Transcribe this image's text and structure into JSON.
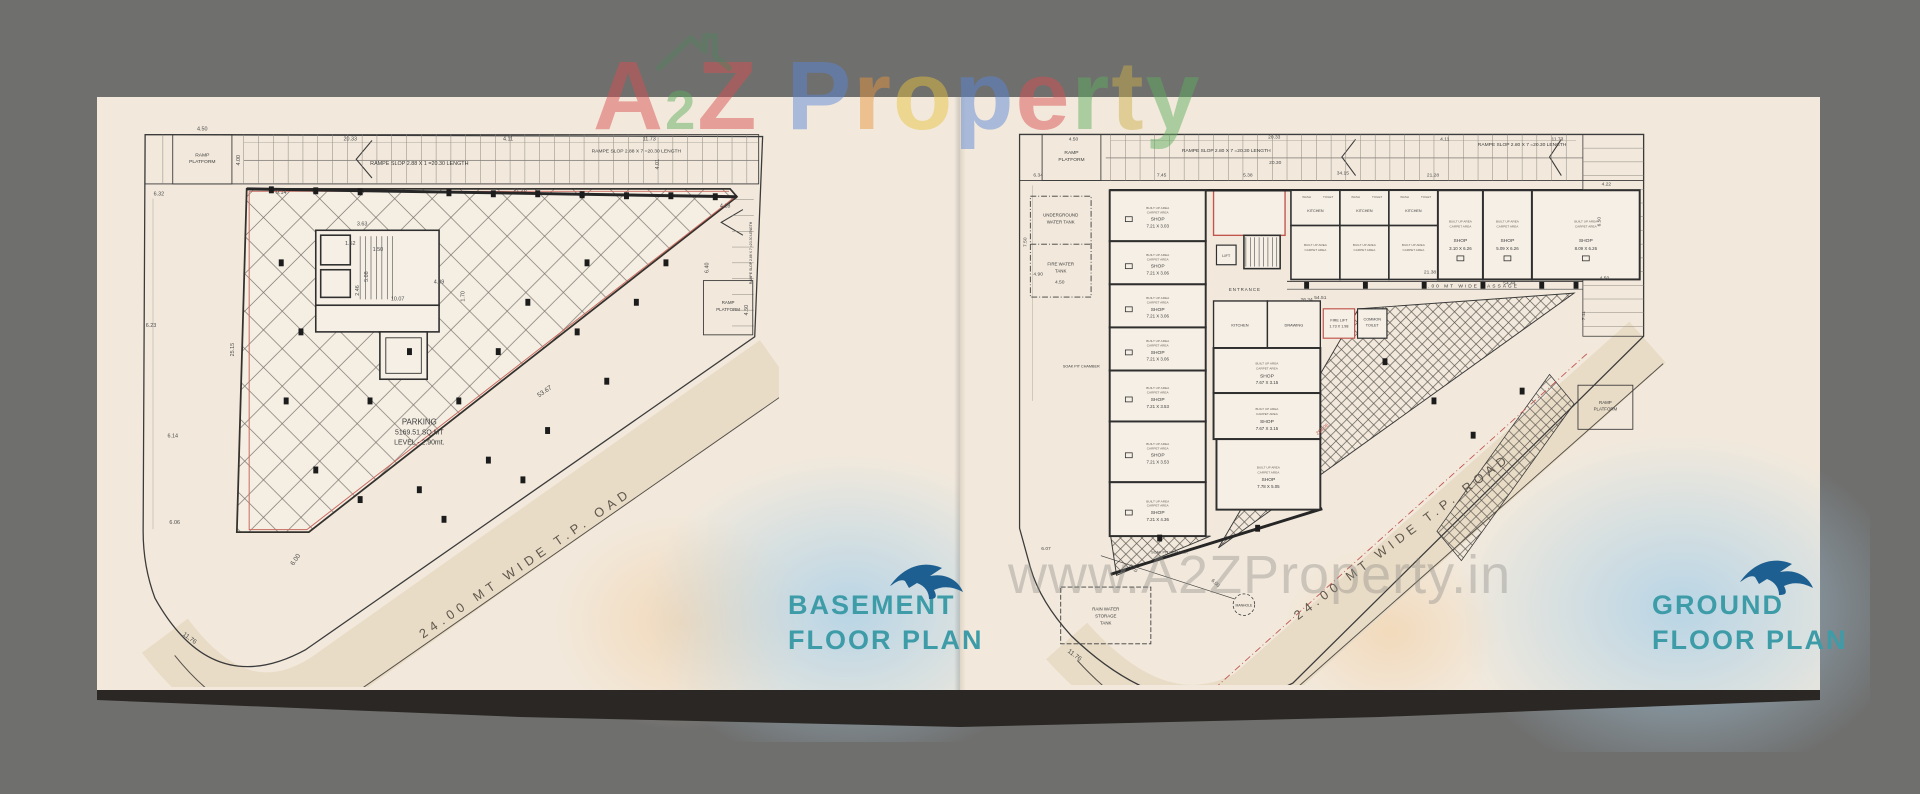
{
  "colors": {
    "background": "#6f6f6e",
    "panel": "#f2e9dc",
    "road": "#e9dcc6",
    "line": "#3b3b3b",
    "red_accent": "#c0564e",
    "title_teal": "#3D9CA8",
    "bird_blue": "#1D5F90",
    "shadow": "#2a2724",
    "watermark_gray": "#8b8a86"
  },
  "watermark_top": {
    "word1_letters": [
      {
        "ch": "A",
        "c": "#db4f4f",
        "sub": false
      },
      {
        "ch": "2",
        "c": "#5fae5f",
        "sub": true
      },
      {
        "ch": "Z",
        "c": "#db4f4f",
        "sub": false
      }
    ],
    "word2_letters": [
      {
        "ch": "P",
        "c": "#5b87d7",
        "sub": false
      },
      {
        "ch": "r",
        "c": "#e8953f",
        "sub": false
      },
      {
        "ch": "o",
        "c": "#e6c23e",
        "sub": false
      },
      {
        "ch": "p",
        "c": "#5b87d7",
        "sub": false
      },
      {
        "ch": "e",
        "c": "#db4f4f",
        "sub": false
      },
      {
        "ch": "r",
        "c": "#5fae5f",
        "sub": false
      },
      {
        "ch": "t",
        "c": "#cdb04a",
        "sub": false
      },
      {
        "ch": "y",
        "c": "#5fae5f",
        "sub": false
      }
    ]
  },
  "watermark_center": "www.A2ZProperty.in",
  "basement": {
    "title": [
      "BASEMENT",
      "FLOOR PLAN"
    ],
    "ramp_platform": [
      "RAMP",
      "PLATFORM"
    ],
    "ramp_platform_right": [
      "RAMP",
      "PLATFORM"
    ],
    "ramp_label_left": "RAMPE SLOP 2.88 X 1 =20.30 LENGTH",
    "ramp_label_right": "RAMPE SLOP 2.88 X 7 =20.30 LENGTH",
    "ramp_label_side": "RAMPE SLOP 2.88 X 7 =20.30 LENGTH",
    "parking": [
      "PARKING",
      "5169.51 SQ.MT",
      "LEVEL - 2.90mt."
    ],
    "road": "24.00 MT WIDE T.P.  OAD",
    "dims": [
      "4.50",
      "20.33",
      "4.11",
      "11.73",
      "6.32",
      "9.14",
      "21.28",
      "6.23",
      "25.15",
      "6.14",
      "6.06",
      "4.00",
      "4.18",
      "6.40",
      "4.50",
      "4.01",
      "3.63",
      "1.52",
      "1.50",
      "5.08",
      "2.46",
      "10.07",
      "4.39",
      "1.70",
      "53.67",
      "6.00",
      "11.76"
    ]
  },
  "ground": {
    "title": [
      "GROUND",
      "FLOOR PLAN"
    ],
    "ramp_platform": [
      "RAMP",
      "PLATFORM"
    ],
    "ramp_platform_right": [
      "RAMP",
      "PLATFORM"
    ],
    "ramp_label_left": "RAMPE SLOP 2.80 X 7 =20.30 LENGTH",
    "ramp_label_right": "RAMPE SLOP 2.80 X 7 =20.30 LENGTH",
    "ramp_label_side": "RAMPE SLOP 2.80 X 7 =20.30 LENGTH",
    "underground_tank": [
      "UNDERGROUND",
      "WATER TANK"
    ],
    "fire_tank": [
      "FIRE WATER",
      "TANK"
    ],
    "rain_tank": [
      "RAIN WATER",
      "STORAGE",
      "TANK"
    ],
    "entrance": "ENTRANCE",
    "lift": "LIFT",
    "fire_lift": [
      "FIRE LIFT",
      "1.73 X 1.98"
    ],
    "common_toilet": [
      "COMMON",
      "TOILET"
    ],
    "passage": "2.00 MT WIDE PASSAGE",
    "kitchen": "KITCHEN",
    "drawing": "DRAWING",
    "wash": "WASH",
    "toilet": "TOILET",
    "soak_pit": "SOAK PIT CHAMBER",
    "manhole": "MANHOLE",
    "built_up": "BUILT UP AREA",
    "carpet": "CARPET AREA",
    "shop_word": "SHOP",
    "shops_left": [
      "7.21 X 3.03",
      "7.21 X 3.06",
      "7.21 X 3.06",
      "7.21 X 3.06",
      "7.21 X 3.53",
      "7.21 X 3.53",
      "7.21 X 4.36"
    ],
    "shops_top": [
      "3.10 X 6.26",
      "5.09 X 6.26",
      "8.09 X 6.26"
    ],
    "shops_mid": [
      "7.67 X 3.15",
      "7.67 X 3.15",
      "7.78 X 5.05"
    ],
    "road": "24.00 MT WIDE T.P. ROAD",
    "dims": [
      "4.50",
      "20.33",
      "20.30",
      "4.11",
      "11.73",
      "6.34",
      "7.45",
      "5.38",
      "34.15",
      "21.28",
      "4.22",
      "4.90",
      "7.50",
      "4.50",
      "54.51",
      "21.38",
      "54.44",
      "26.34",
      "263.06",
      "6.50",
      "4.50",
      "7.11",
      "6.07",
      "6.20",
      "6.00",
      "11.76"
    ]
  }
}
